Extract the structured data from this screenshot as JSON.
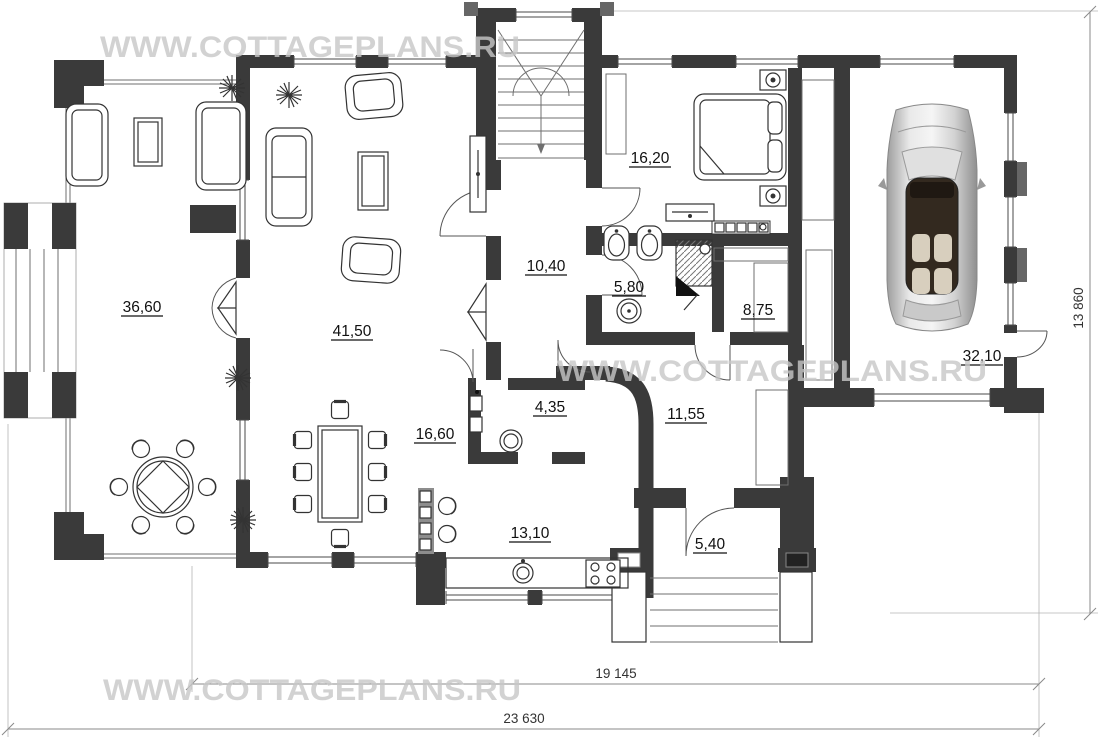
{
  "page": {
    "background": "#ffffff"
  },
  "watermark": {
    "text": "WWW.COTTAGEPLANS.RU",
    "color": "#c8c8c8"
  },
  "plan": {
    "rooms": [
      {
        "id": "terrace",
        "area": "36,60"
      },
      {
        "id": "living-room",
        "area": "41,50"
      },
      {
        "id": "dining-area",
        "area": "16,60"
      },
      {
        "id": "kitchen",
        "area": "13,10"
      },
      {
        "id": "hallway",
        "area": "10,40"
      },
      {
        "id": "bathroom",
        "area": "5,80"
      },
      {
        "id": "wc",
        "area": "4,35"
      },
      {
        "id": "bedroom",
        "area": "16,20"
      },
      {
        "id": "wardrobe",
        "area": "8,75"
      },
      {
        "id": "hall",
        "area": "11,55"
      },
      {
        "id": "porch",
        "area": "5,40"
      },
      {
        "id": "garage",
        "area": "32,10"
      }
    ],
    "dimensions": {
      "bottom_inner": "19 145",
      "bottom_outer": "23 630",
      "right_vertical": "13 860"
    },
    "colors": {
      "wall": "#3a3a3a",
      "wall_accent": "#6a6a6a",
      "furniture_line": "#333333",
      "dimension_line": "#8a8a8a",
      "car_cabin": "#33291f",
      "car_seat": "#d8cfbe"
    }
  }
}
